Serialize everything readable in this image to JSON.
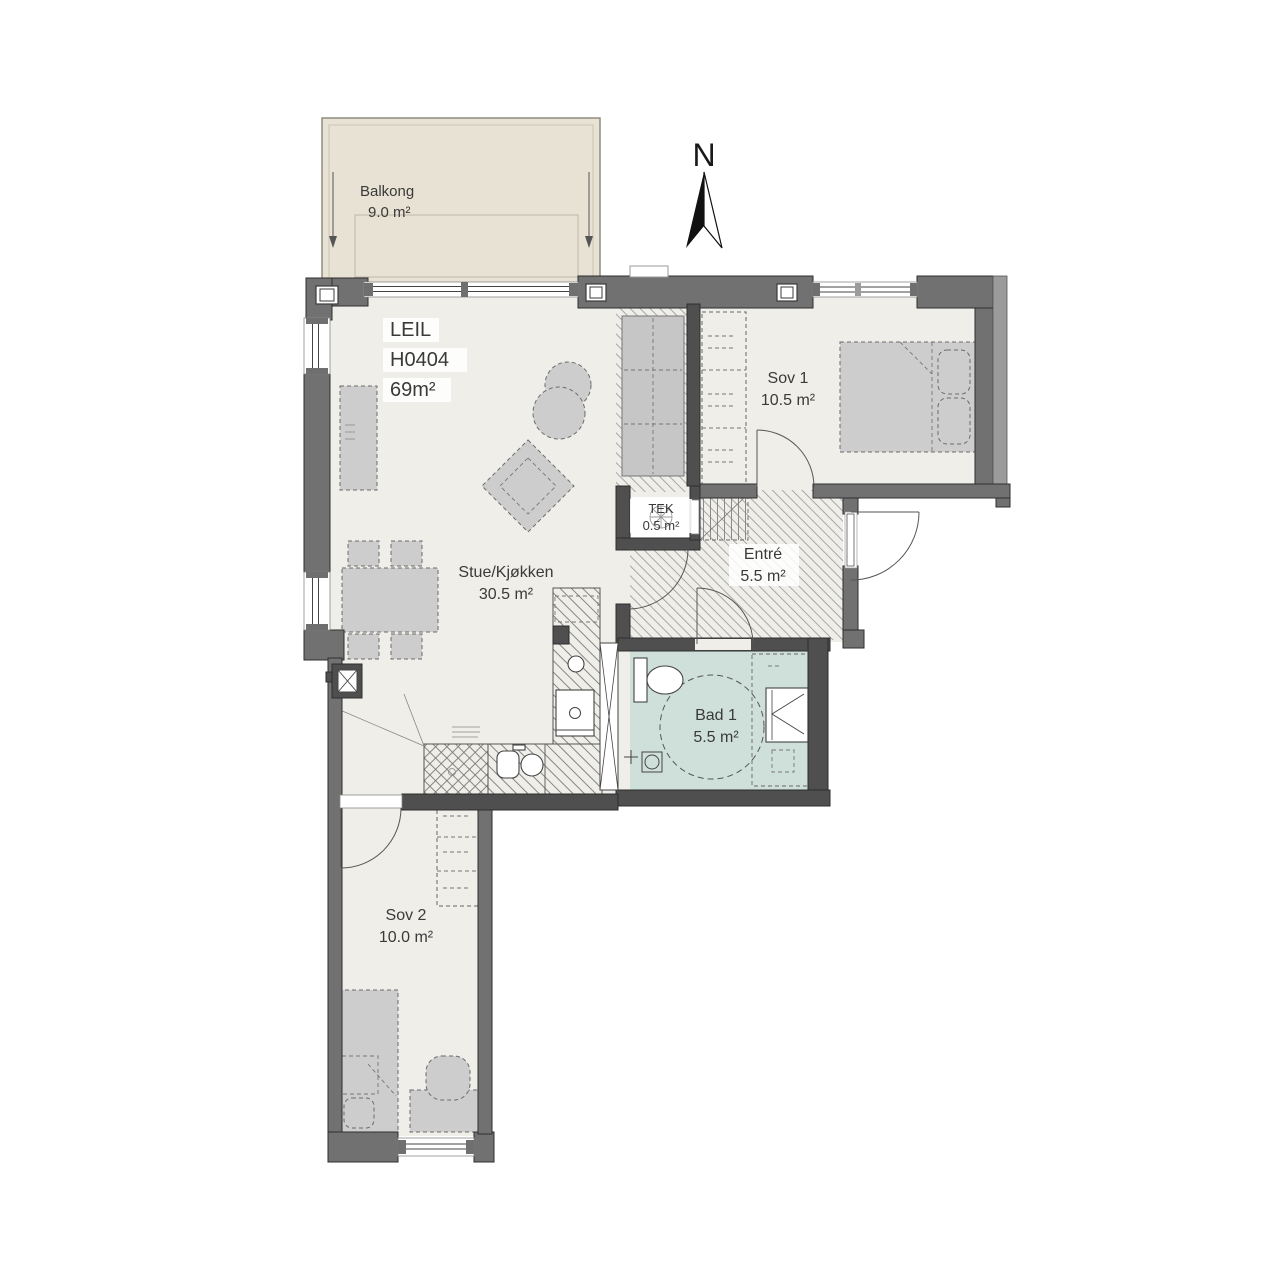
{
  "title": "Leilighet H0404 plantegning",
  "north": {
    "label": "N"
  },
  "apartment": {
    "label": "LEIL",
    "unit": "H0404",
    "area": "69m²"
  },
  "rooms": [
    {
      "name": "Balkong",
      "area": "9.0 m²"
    },
    {
      "name": "Stue/Kjøkken",
      "area": "30.5 m²"
    },
    {
      "name": "Sov 1",
      "area": "10.5 m²"
    },
    {
      "name": "TEK",
      "area": "0.5 m²"
    },
    {
      "name": "Entré",
      "area": "5.5 m²"
    },
    {
      "name": "Bad 1",
      "area": "5.5 m²"
    },
    {
      "name": "Sov 2",
      "area": "10.0 m²"
    }
  ],
  "colors": {
    "wall_exterior": "#717171",
    "wall_interior": "#4f4f4f",
    "floor": "#efeee9",
    "balcony": "#e8e2d4",
    "bathroom": "#cfe0da",
    "furniture": "#cdcdcd",
    "text": "#3a3a3a"
  }
}
